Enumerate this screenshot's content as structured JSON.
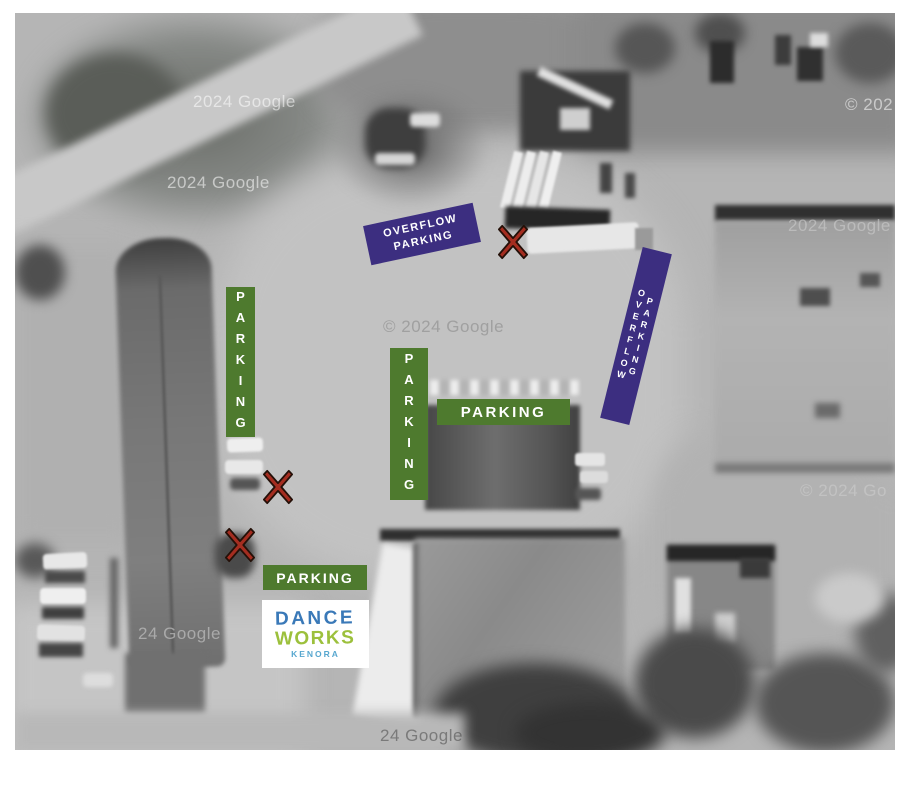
{
  "map": {
    "watermarks": [
      {
        "text": "2024 Google"
      },
      {
        "text": "2024 Google"
      },
      {
        "text": "© 2024 Google"
      },
      {
        "text": "© 202"
      },
      {
        "text": "2024 Google"
      },
      {
        "text": "© 2024 Go"
      },
      {
        "text": "24 Google"
      },
      {
        "text": "24 Google"
      }
    ],
    "signs": {
      "overflow_rotated": {
        "label": "OVERFLOW PARKING"
      },
      "overflow_vertical": {
        "label": "OVERFLOW PARKING"
      },
      "parking_vertical_left": {
        "label": "PARKING"
      },
      "parking_vertical_mid": {
        "label": "PARKING"
      },
      "parking_horizontal_upper": {
        "label": "PARKING"
      },
      "parking_horizontal_lower": {
        "label": "PARKING"
      }
    },
    "logo": {
      "line1": "DANCE",
      "line2": "WORKS",
      "line3": "KENORA"
    },
    "colors": {
      "parking_green": "#4e7a2e",
      "overflow_purple": "#3c2e80",
      "marker_red": "#a42d20",
      "logo_blue": "#3a79b8",
      "logo_green": "#9cc03c",
      "logo_light_blue": "#57a7cf"
    }
  }
}
